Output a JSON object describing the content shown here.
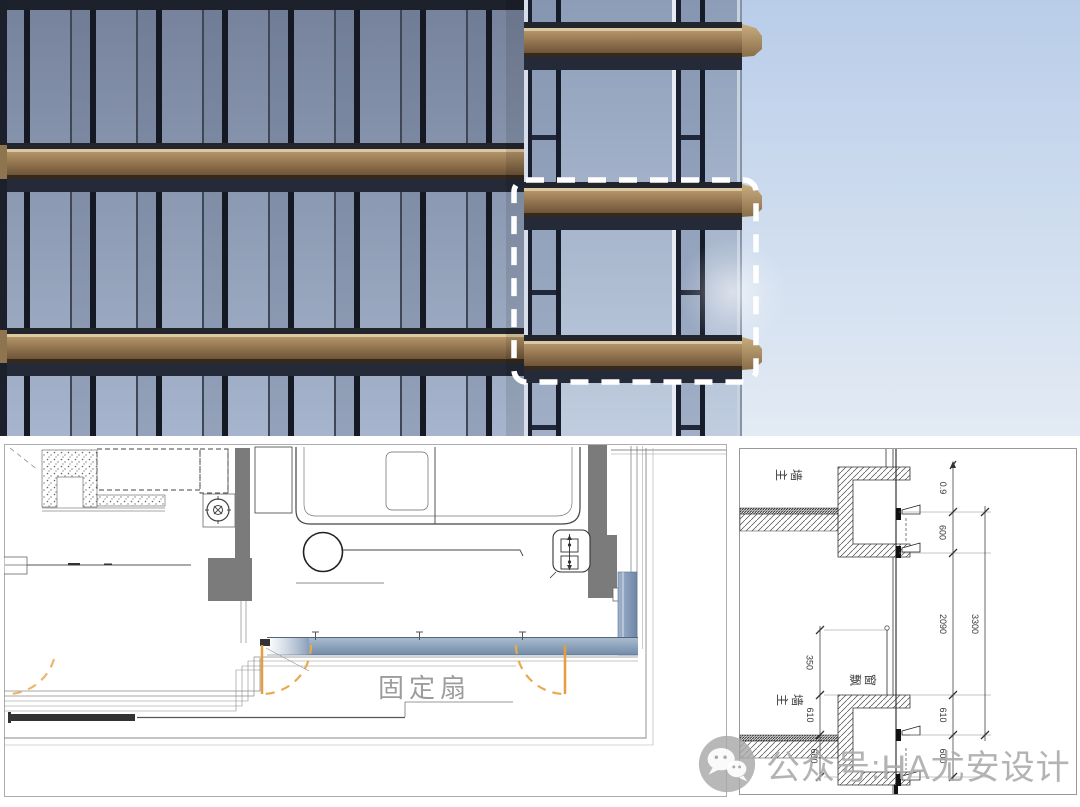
{
  "facade_photo": {
    "selection_box": "dashed-white-rounded-rectangle",
    "colors": {
      "sky_top": "#b9cde9",
      "sky_bottom": "#e3ebf4",
      "glass_dark": "#76829b",
      "glass_light": "#a6b5cd",
      "bay_glass_light": "#c0cde0",
      "bronze_band": "#8a6f4c",
      "bronze_highlight": "#dbc8a5",
      "mullion": "#161c2a",
      "selection_dash": "#ffffff"
    }
  },
  "plan_detail": {
    "fixed_sash_label": "固定扇",
    "colors": {
      "casement_orange": "#e59d3e",
      "glazing_blue": "#7e96b4",
      "column_gray": "#7b7b7b",
      "label_gray": "#9c9c9c"
    }
  },
  "section_detail": {
    "labels": {
      "top_wall": "主墙",
      "bay_window": "飘窗",
      "bottom_wall": "主墙"
    },
    "dims_left": [
      "350",
      "610",
      "600"
    ],
    "dims_right": [
      "0.9",
      "600",
      "2090",
      "610",
      "600"
    ],
    "dim_overall": "3300"
  },
  "watermark": {
    "icon": "wechat-logo",
    "text": "公众号:HA尤安设计"
  }
}
